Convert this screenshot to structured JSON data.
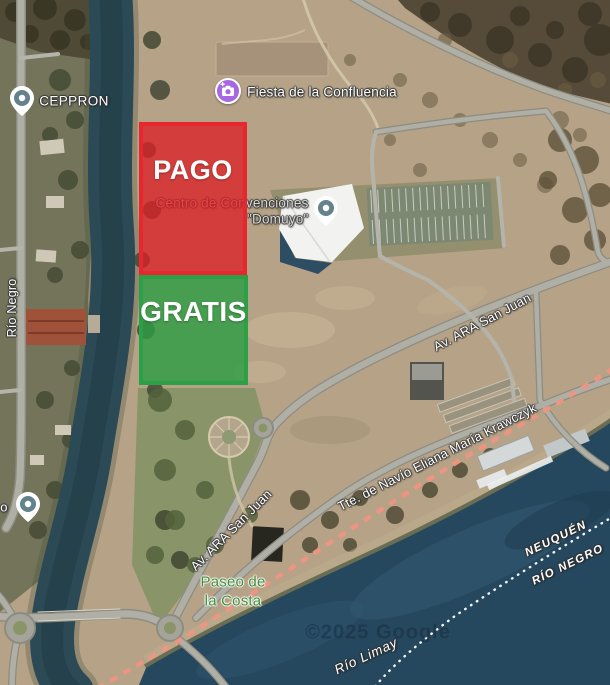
{
  "overlays": {
    "pago": {
      "label": "PAGO",
      "fill_color": "rgba(219,33,38,0.78)",
      "border_color": "#e8262d"
    },
    "gratis": {
      "label": "GRATIS",
      "fill_color": "rgba(44,157,66,0.8)",
      "border_color": "#2aa047"
    }
  },
  "markers": {
    "ceppron": {
      "label": "CEPPRON",
      "type": "place-pin",
      "pin_color": "#64828e"
    },
    "fiesta": {
      "label": "Fiesta de la Confluencia",
      "type": "photo-spot",
      "color": "#a767e0"
    },
    "centro": {
      "label_line1": "Centro de Convenciones",
      "label_line2": "\"Domuyo\"",
      "type": "place-pin",
      "pin_color": "#64828e"
    },
    "partial": {
      "label": "o",
      "type": "place-pin",
      "pin_color": "#64828e"
    }
  },
  "road_labels": {
    "rio_negro_street": "Río Negro",
    "ara_san_juan_upper": "Av. ARA San Juan",
    "ara_san_juan_lower": "Av. ARA San Juan",
    "krawczyk": "Tte. de Navío Eliana María Krawczyk"
  },
  "area_labels": {
    "paseo_line1": "Paseo de",
    "paseo_line2": "la Costa"
  },
  "boundary_labels": {
    "neuquen": "NEUQUÉN",
    "rio_negro_province": "RÍO NEGRO"
  },
  "water_labels": {
    "rio_limay": "Río Limay"
  },
  "watermark": "©2025 Google"
}
